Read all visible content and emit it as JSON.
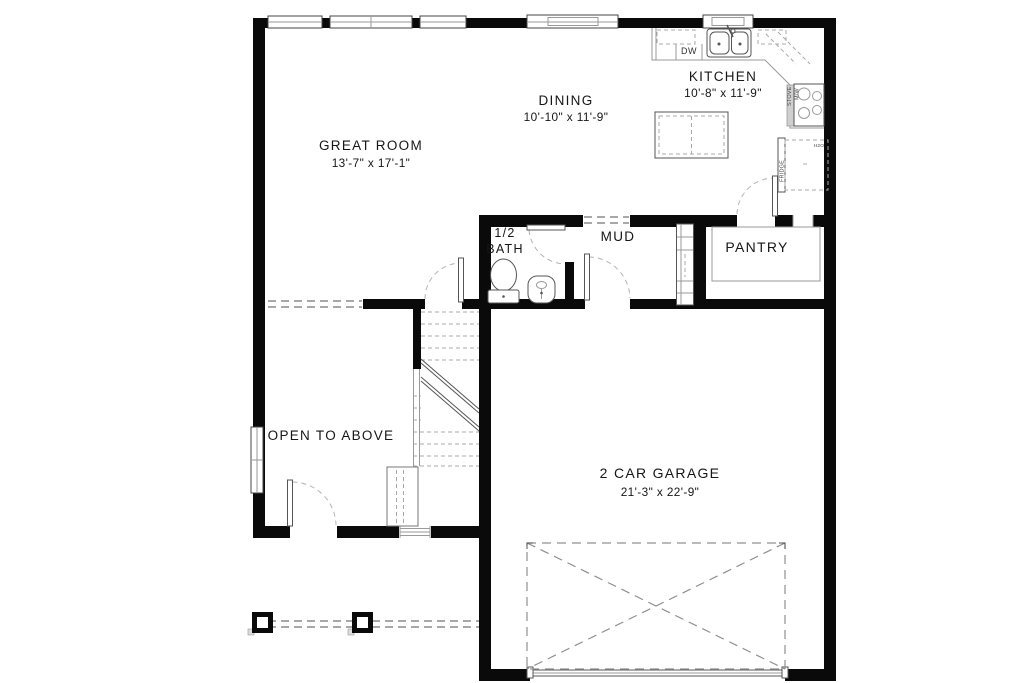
{
  "colors": {
    "wall": "#0a0a0a",
    "line": "#9a9a9a",
    "text": "#161616"
  },
  "rooms": {
    "great_room": {
      "name": "GREAT ROOM",
      "dims": "13'-7\" x 17'-1\""
    },
    "dining": {
      "name": "DINING",
      "dims": "10'-10\" x 11'-9\""
    },
    "kitchen": {
      "name": "KITCHEN",
      "dims": "10'-8\" x 11'-9\""
    },
    "half_bath": {
      "line1": "1/2",
      "line2": "BATH"
    },
    "mud": {
      "name": "MUD"
    },
    "pantry": {
      "name": "PANTRY"
    },
    "open_to_above": {
      "name": "OPEN TO ABOVE"
    },
    "garage": {
      "name": "2 CAR GARAGE",
      "dims": "21'-3\" x 22'-9\""
    }
  },
  "appliances": {
    "dishwasher": "DW",
    "stove": "STOVE",
    "microwave": "M/W",
    "fridge": "FRIDGE",
    "water_line": "H2O"
  }
}
